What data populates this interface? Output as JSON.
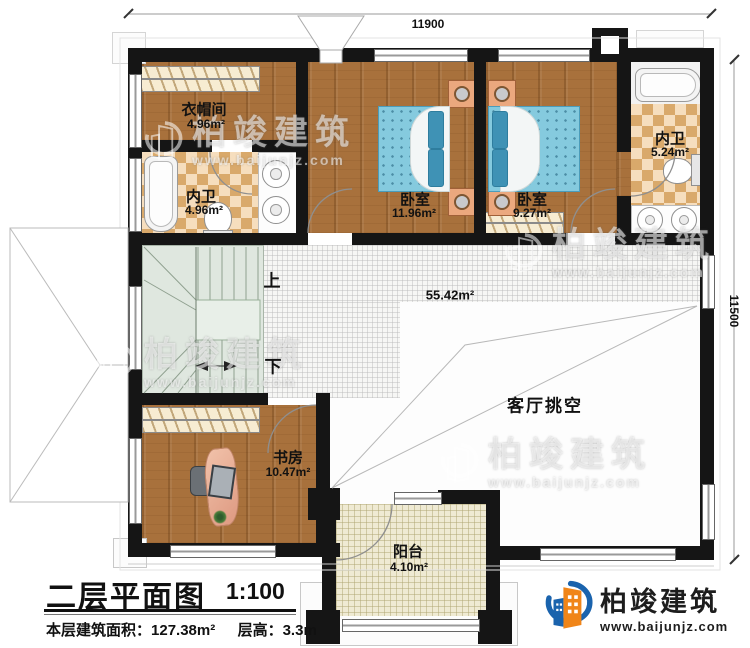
{
  "dimensions": {
    "top": "11900",
    "right": "11500"
  },
  "rooms": {
    "cloakroom": {
      "name": "衣帽间",
      "area": "4.96m²"
    },
    "inner_bath_left": {
      "name": "内卫",
      "area": "4.96m²"
    },
    "bedroom_left": {
      "name": "卧室",
      "area": "11.96m²"
    },
    "bedroom_right": {
      "name": "卧室",
      "area": "9.27m²"
    },
    "inner_bath_right": {
      "name": "内卫",
      "area": "5.24m²"
    },
    "hall": {
      "area": "55.42m²"
    },
    "living_void": {
      "name": "客厅挑空"
    },
    "study": {
      "name": "书房",
      "area": "10.47m²"
    },
    "balcony": {
      "name": "阳台",
      "area": "4.10m²"
    }
  },
  "stairs": {
    "up_label": "上",
    "down_label": "下"
  },
  "watermark": {
    "brand": "柏竣建筑",
    "url": "www.baijunjz.com"
  },
  "title_block": {
    "title": "二层平面图",
    "scale": "1:100",
    "area_label": "本层建筑面积：",
    "area_value": "127.38m²",
    "height_label": "层高：",
    "height_value": "3.3m"
  },
  "logo": {
    "brand": "柏竣建筑",
    "url": "www.baijunjz.com"
  },
  "colors": {
    "wall": "#151515",
    "wood": "#a8713c",
    "check_dark": "#d9a96b",
    "check_light": "#f6debe",
    "bed_blue": "#85cade",
    "stair_green": "#dfe7df",
    "balcony_floor": "#efead3",
    "logo_blue": "#1a63ad",
    "logo_orange": "#f08519"
  }
}
